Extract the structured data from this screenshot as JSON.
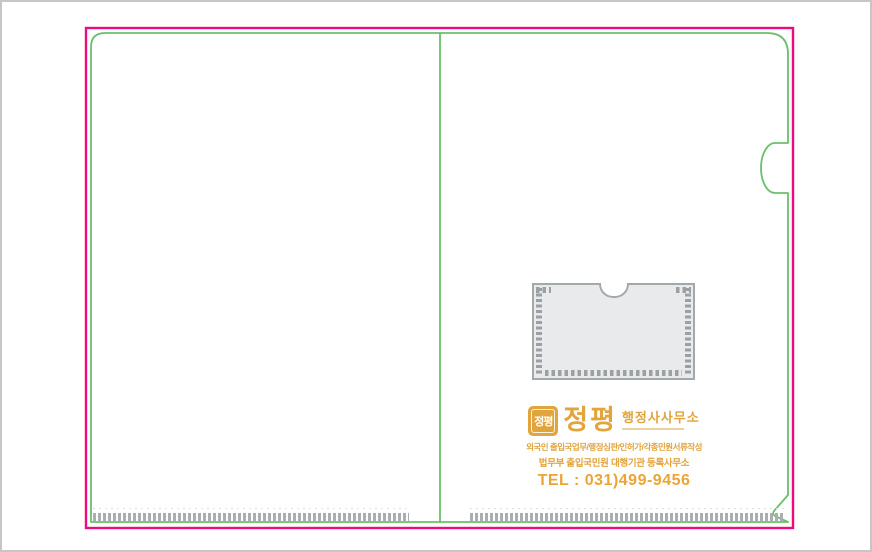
{
  "artboard": {
    "description_colors": {
      "cut_line": "#ee0a81",
      "fold_line": "#69c069",
      "brand_gold": "#e2a43c",
      "tel_orange": "#eda437",
      "pocket_fill": "#e9eaec",
      "pocket_border": "#a3a8ac",
      "weld_tick_gray": "#9aa0a4",
      "canvas_border": "#c6c6c6",
      "background": "#ffffff"
    }
  },
  "branding": {
    "seal_text": "정평",
    "name": "정평",
    "suffix": "행정사사무소",
    "services_line1": "외국인 출입국업무/행정심판/인허가/각종민원서류작성",
    "services_line2": "법무부 출입국민원 대행기관 등록사무소",
    "tel": "TEL : 031)499-9456"
  }
}
